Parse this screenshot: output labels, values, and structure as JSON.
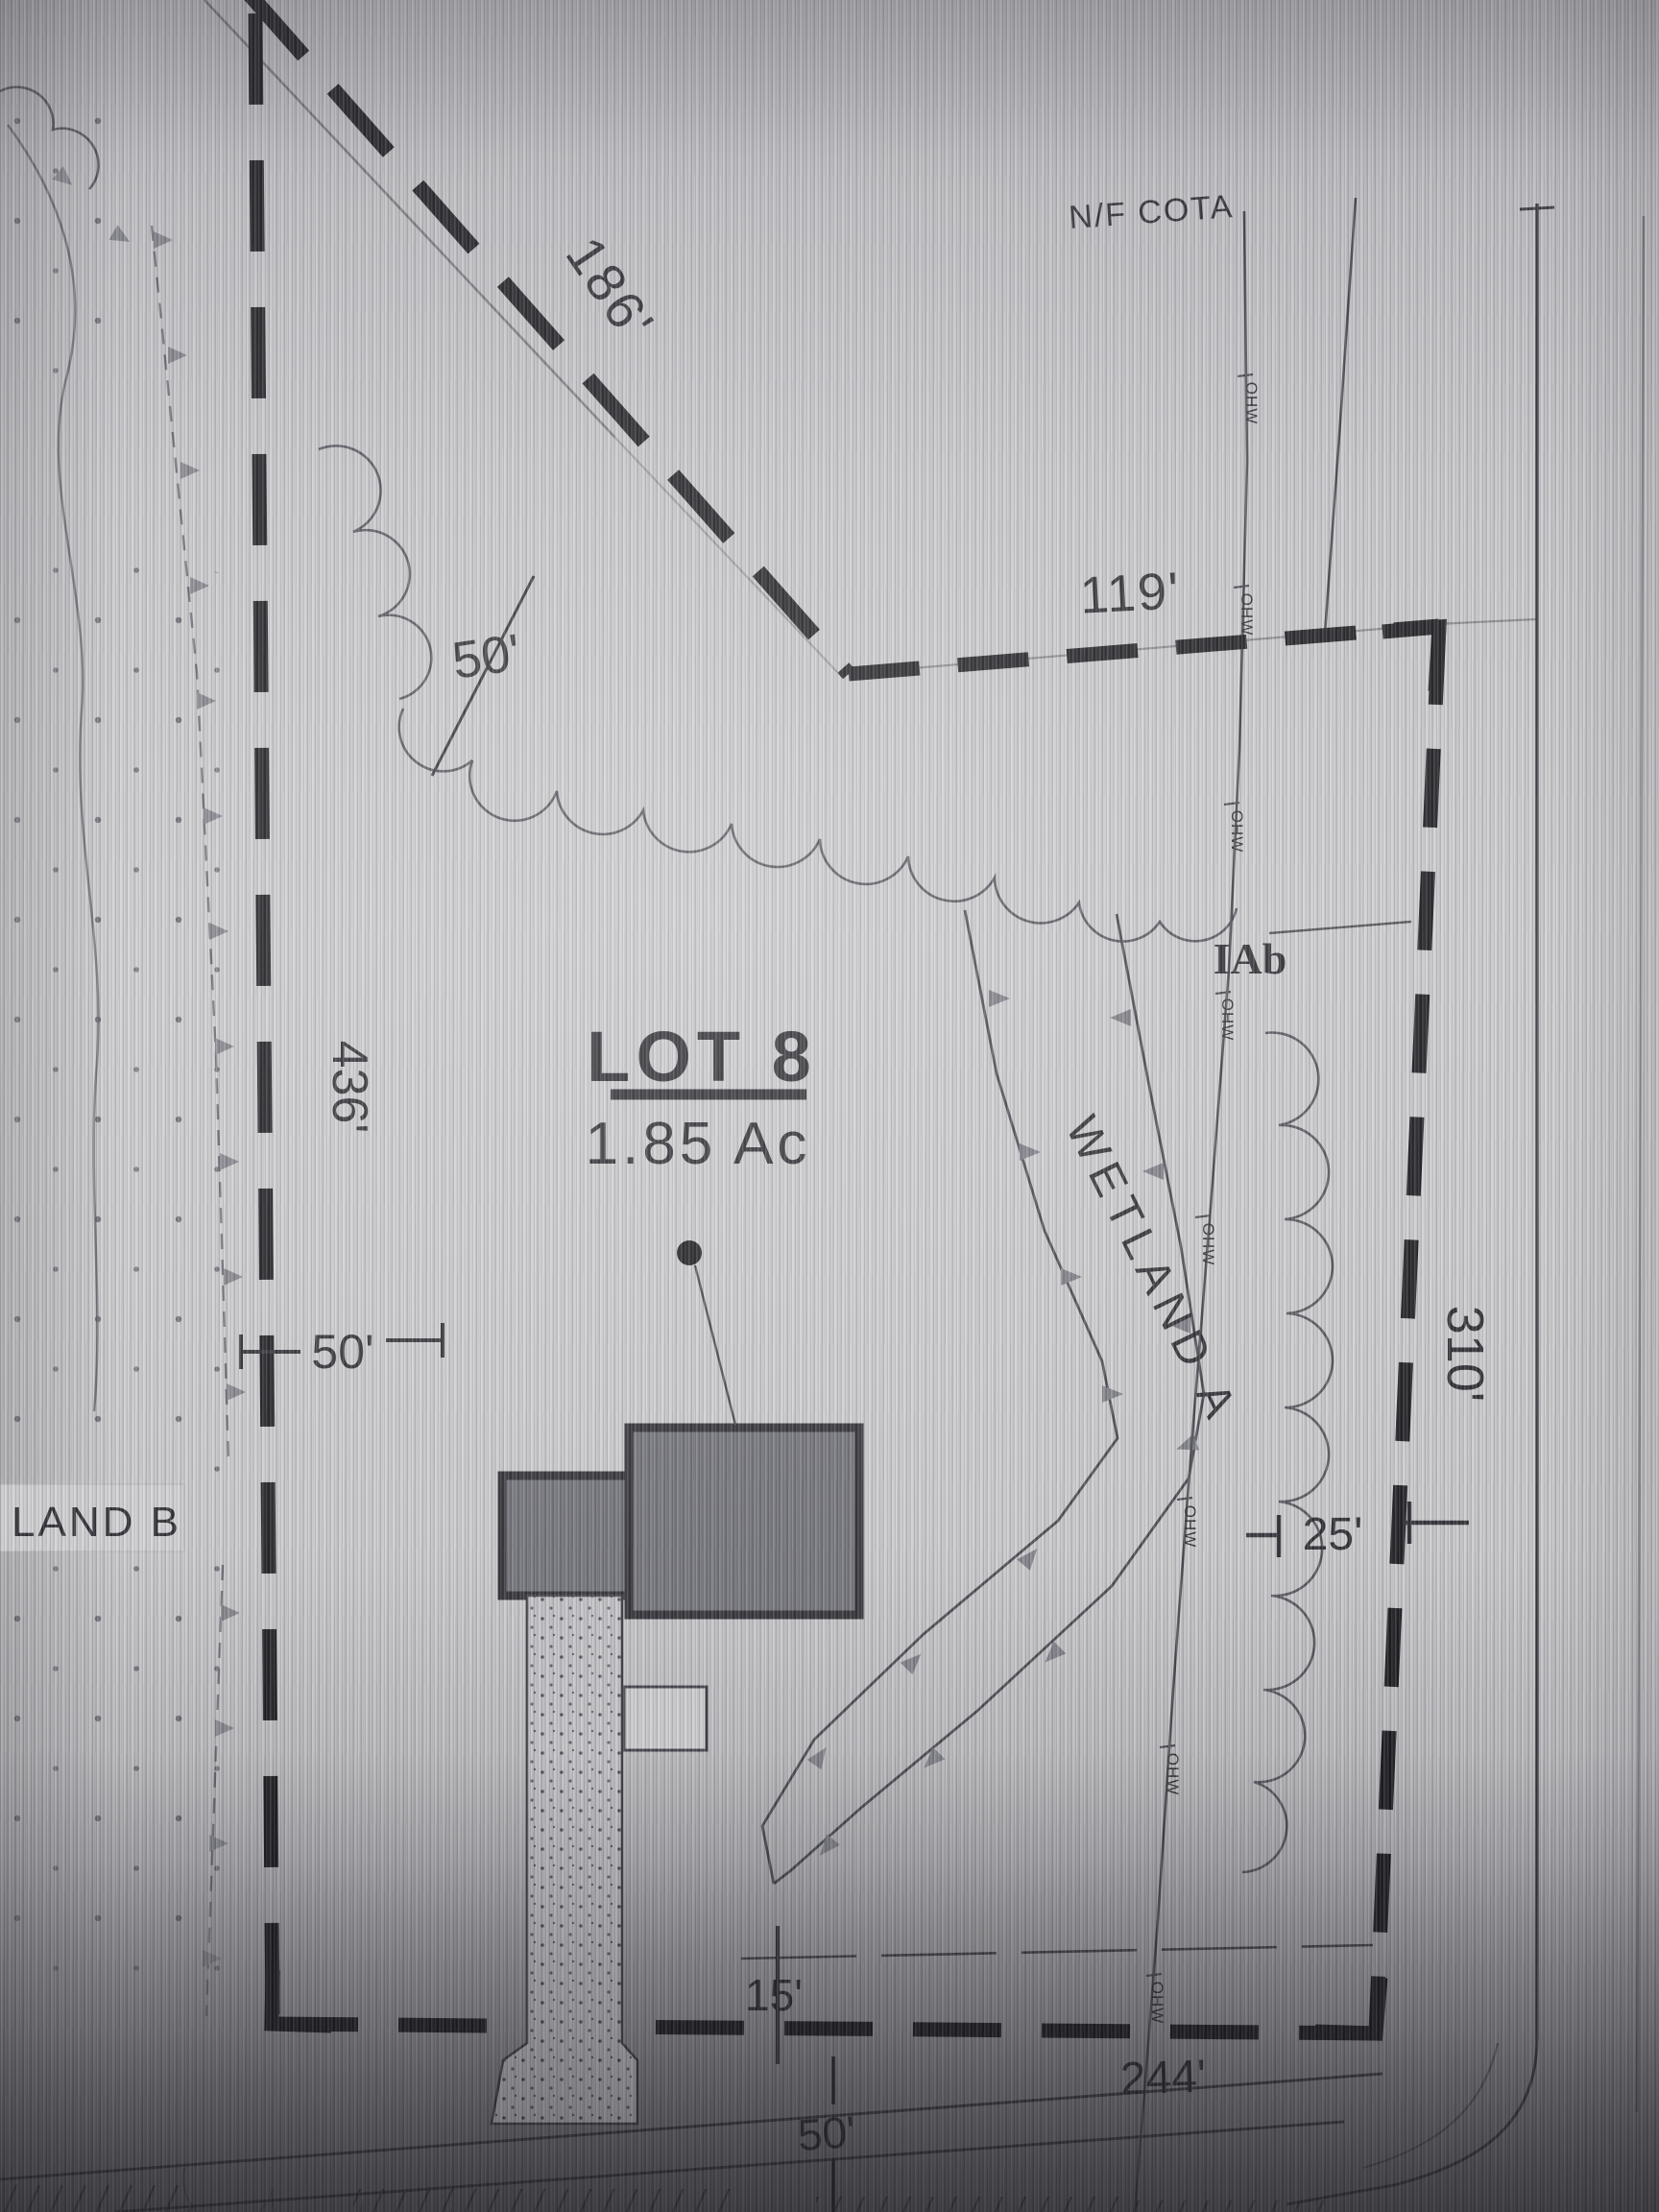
{
  "plan": {
    "owner_label": "N/F COTA",
    "lot": {
      "title": "LOT 8",
      "area": "1.85 Ac"
    },
    "wetlands": {
      "a": "WETLAND A",
      "b": "LAND B"
    },
    "soil_label": "IAb",
    "utility_label": "OHW",
    "dimensions": {
      "north_diagonal": "186'",
      "north_east": "119'",
      "strip_top": "50'",
      "west": "436'",
      "west_offset": "50'",
      "east": "310'",
      "east_offset": "25'",
      "south_setback": "15'",
      "south_east": "244'",
      "south_road": "50'"
    },
    "colors": {
      "ink": "#2a2a30",
      "gray_label": "#7b7b84",
      "paper": "#c9c9cd"
    }
  }
}
